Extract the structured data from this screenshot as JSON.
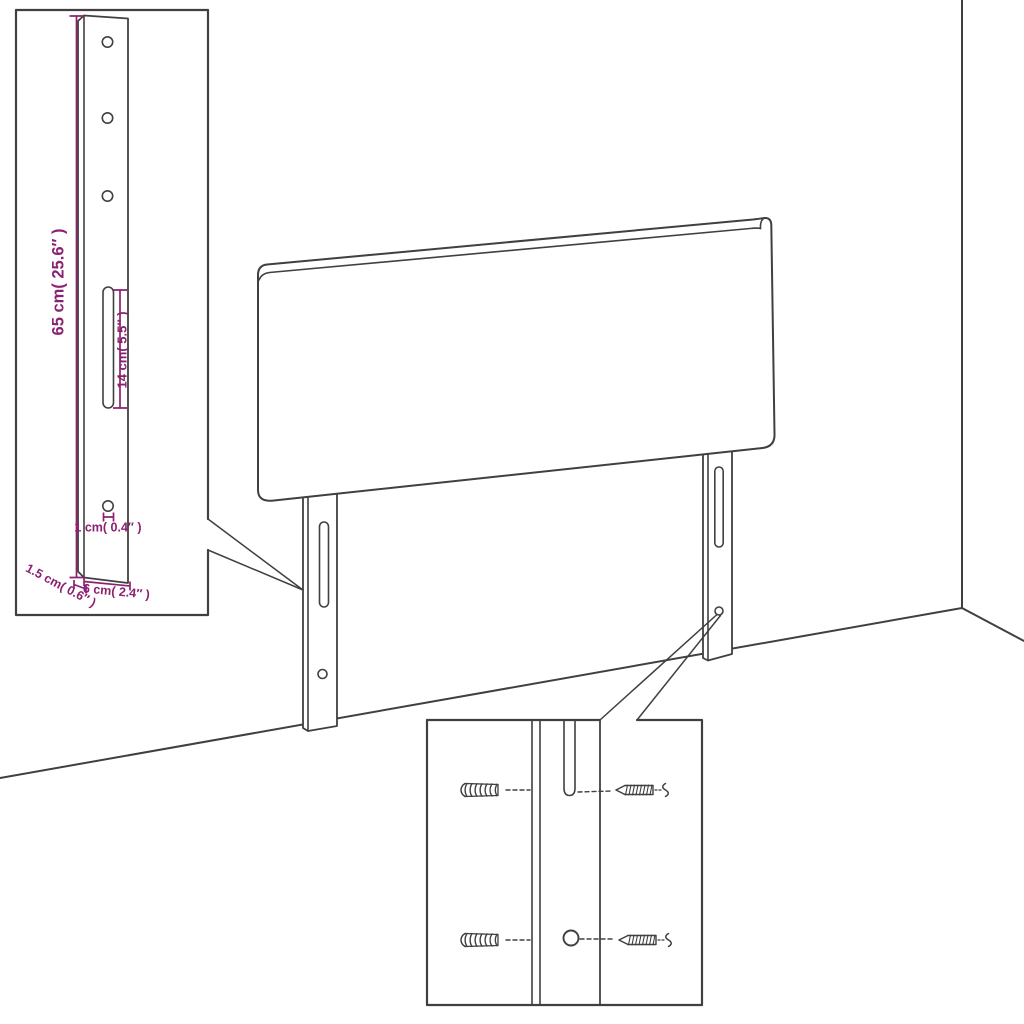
{
  "diagram": {
    "background_color": "#ffffff",
    "line_color": "#404040",
    "dimension_color": "#8b2270",
    "leg_detail": {
      "height_label": "65 cm( 25.6″ )",
      "slot_length_label": "14 cm( 5.5″ )",
      "hole_diameter_label": "1 cm( 0.4″ )",
      "depth_label": "1.5 cm( 0.6″ )",
      "width_label": "6 cm( 2.4″ )"
    }
  }
}
